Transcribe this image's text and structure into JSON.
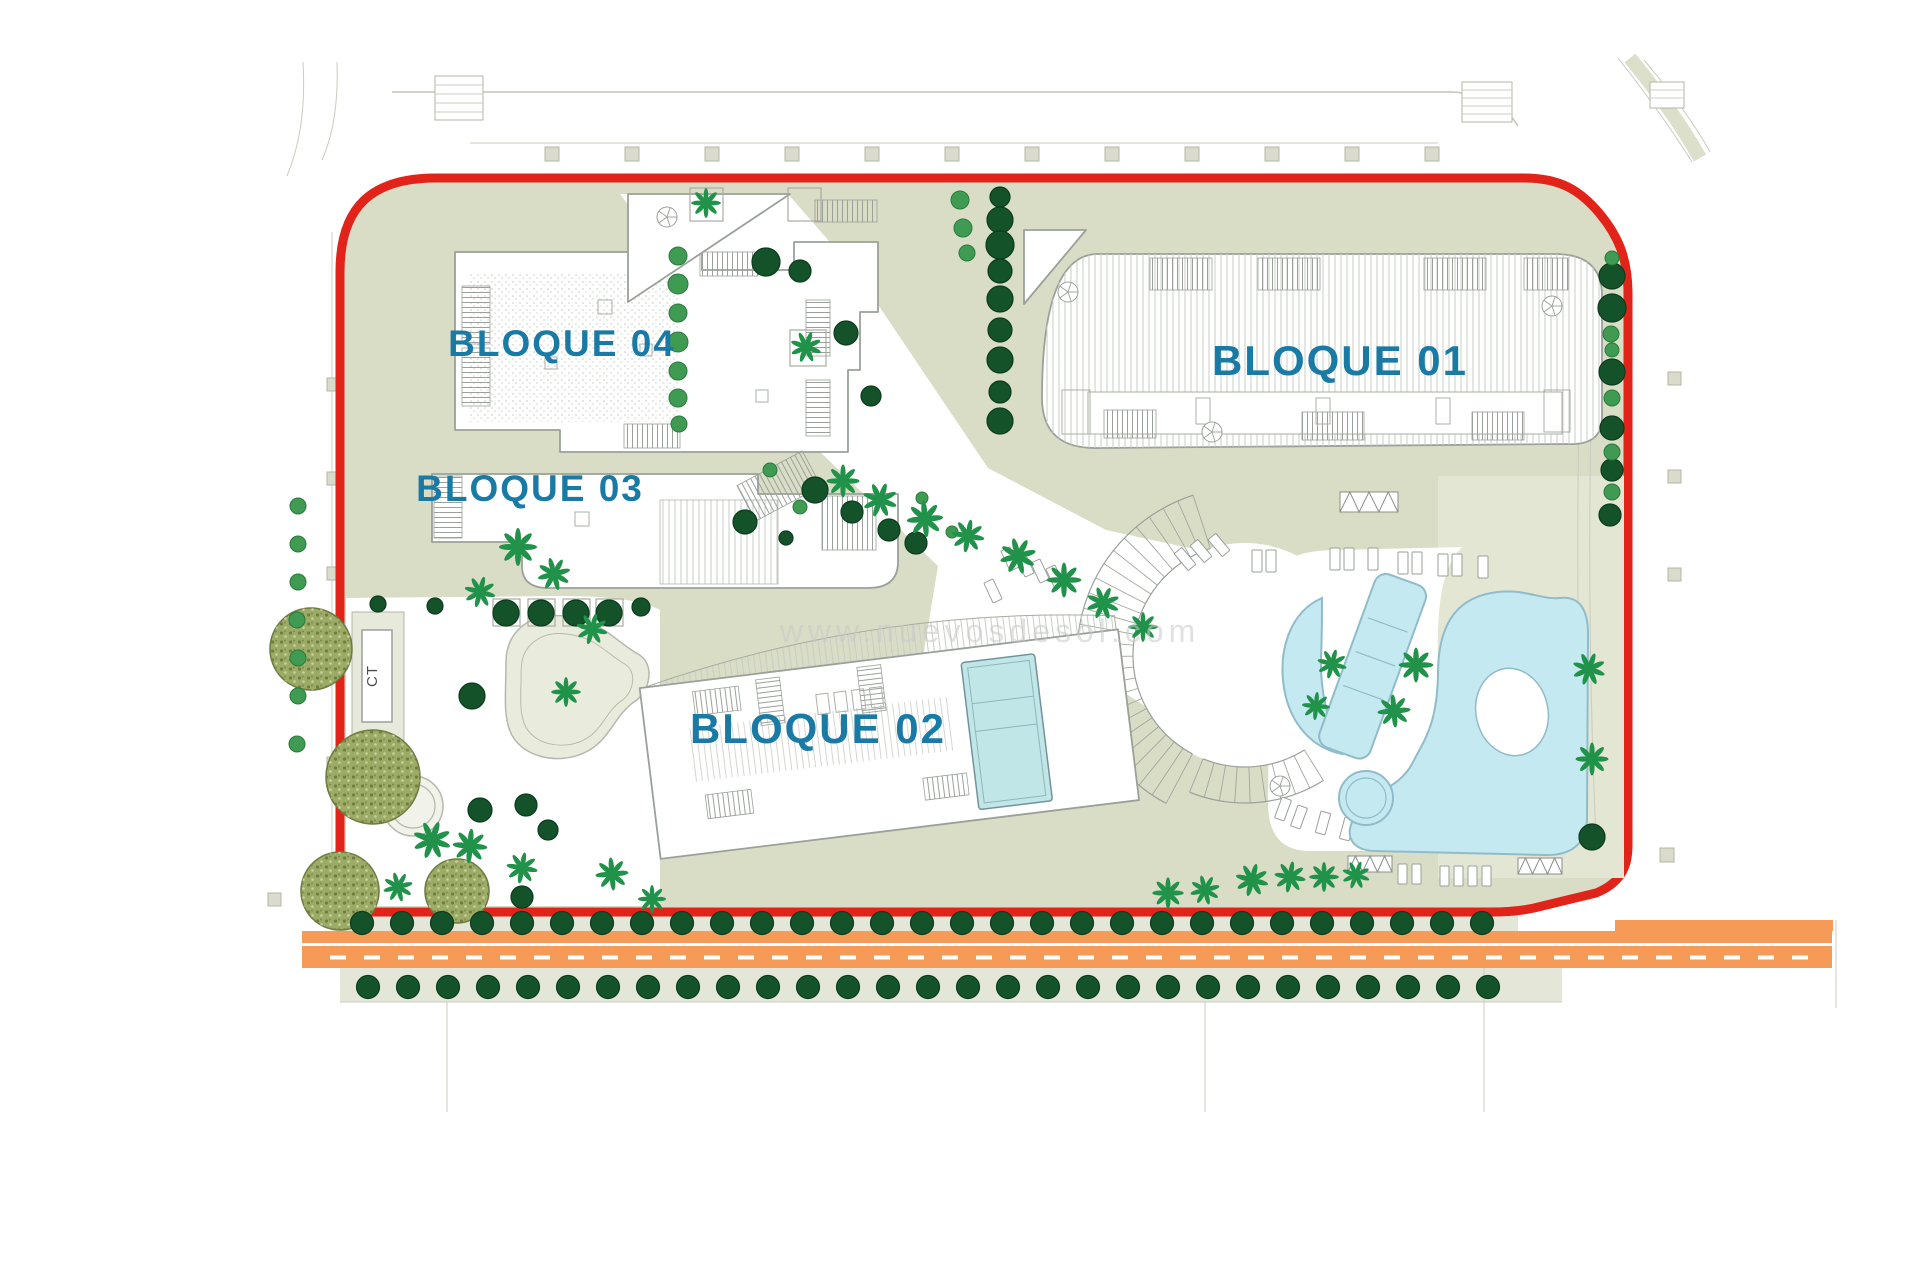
{
  "labels": {
    "blocks": [
      {
        "id": "bloque-01",
        "text": "BLOQUE 01"
      },
      {
        "id": "bloque-02",
        "text": "BLOQUE 02"
      },
      {
        "id": "bloque-03",
        "text": "BLOQUE 03"
      },
      {
        "id": "bloque-04",
        "text": "BLOQUE 04"
      }
    ],
    "transformer": "CT",
    "watermark": "www.nuevosdesol.com"
  },
  "colors": {
    "boundary_red": "#e2231a",
    "sage": "#d9ddc6",
    "sage_light": "#e3e6d3",
    "sage_strip": "#e4e6d7",
    "road_orange": "#f59a57",
    "pool_blue": "#c4e9f1",
    "pool_stroke": "#90bcca",
    "label_blue": "#1a7aa6",
    "watermark_gray": "#c9c9c9",
    "tree_dark": "#14522a",
    "tree_dark_stroke": "#0d3b1e",
    "tree_medium": "#3f9b52",
    "palm_green": "#21924a",
    "olive_fill": "#9cab66",
    "olive_stroke": "#6c7b40"
  },
  "map": {
    "trees_dark": [
      [
        1000,
        197,
        10
      ],
      [
        1000,
        220,
        13
      ],
      [
        1000,
        245,
        14
      ],
      [
        1000,
        271,
        12
      ],
      [
        1000,
        299,
        13
      ],
      [
        1000,
        330,
        12
      ],
      [
        1000,
        360,
        13
      ],
      [
        1000,
        392,
        11
      ],
      [
        1000,
        421,
        13
      ],
      [
        800,
        271,
        11
      ],
      [
        846,
        333,
        12
      ],
      [
        871,
        396,
        10
      ],
      [
        766,
        262,
        14
      ],
      [
        815,
        490,
        13
      ],
      [
        852,
        512,
        11
      ],
      [
        889,
        530,
        11
      ],
      [
        916,
        543,
        11
      ],
      [
        745,
        522,
        12
      ],
      [
        786,
        538,
        7
      ],
      [
        506,
        613,
        13
      ],
      [
        541,
        613,
        13
      ],
      [
        576,
        613,
        13
      ],
      [
        609,
        613,
        13
      ],
      [
        435,
        606,
        8
      ],
      [
        378,
        604,
        8
      ],
      [
        641,
        607,
        9
      ],
      [
        472,
        696,
        13
      ],
      [
        522,
        897,
        11
      ],
      [
        480,
        810,
        12
      ],
      [
        526,
        805,
        11
      ],
      [
        548,
        830,
        10
      ],
      [
        1612,
        276,
        13
      ],
      [
        1612,
        308,
        14
      ],
      [
        1612,
        372,
        13
      ],
      [
        1612,
        428,
        12
      ],
      [
        1612,
        470,
        11
      ],
      [
        1610,
        515,
        11
      ],
      [
        1592,
        837,
        13
      ]
    ],
    "trees_medium": [
      [
        678,
        256,
        9
      ],
      [
        678,
        284,
        10
      ],
      [
        678,
        313,
        9
      ],
      [
        678,
        342,
        10
      ],
      [
        678,
        371,
        9
      ],
      [
        678,
        398,
        9
      ],
      [
        679,
        424,
        8
      ],
      [
        1612,
        258,
        7
      ],
      [
        1611,
        334,
        8
      ],
      [
        1612,
        350,
        7
      ],
      [
        1612,
        398,
        8
      ],
      [
        1612,
        452,
        8
      ],
      [
        1612,
        492,
        8
      ],
      [
        298,
        506,
        8
      ],
      [
        298,
        544,
        8
      ],
      [
        298,
        582,
        8
      ],
      [
        297,
        620,
        8
      ],
      [
        298,
        658,
        8
      ],
      [
        298,
        696,
        8
      ],
      [
        297,
        744,
        8
      ],
      [
        960,
        200,
        9
      ],
      [
        963,
        228,
        9
      ],
      [
        967,
        253,
        8
      ],
      [
        770,
        470,
        7
      ],
      [
        800,
        507,
        7
      ],
      [
        922,
        498,
        6
      ],
      [
        952,
        532,
        6
      ]
    ],
    "palms": [
      [
        843,
        481,
        1.0,
        0
      ],
      [
        880,
        500,
        1.05,
        20
      ],
      [
        925,
        519,
        1.1,
        40
      ],
      [
        968,
        536,
        1.0,
        10
      ],
      [
        1018,
        556,
        1.1,
        30
      ],
      [
        1064,
        580,
        1.05,
        0
      ],
      [
        1103,
        603,
        1.0,
        25
      ],
      [
        1143,
        627,
        0.9,
        45
      ],
      [
        518,
        547,
        1.15,
        0
      ],
      [
        554,
        574,
        1.0,
        30
      ],
      [
        480,
        592,
        0.95,
        60
      ],
      [
        592,
        629,
        0.95,
        15
      ],
      [
        566,
        692,
        0.9,
        0
      ],
      [
        432,
        840,
        1.15,
        20
      ],
      [
        470,
        846,
        1.05,
        50
      ],
      [
        522,
        868,
        0.95,
        10
      ],
      [
        612,
        874,
        1.0,
        40
      ],
      [
        652,
        899,
        0.85,
        0
      ],
      [
        398,
        887,
        0.9,
        30
      ],
      [
        706,
        203,
        0.9,
        0
      ],
      [
        806,
        347,
        0.95,
        20
      ],
      [
        1168,
        893,
        0.95,
        0
      ],
      [
        1205,
        890,
        0.9,
        30
      ],
      [
        1252,
        880,
        1.0,
        60
      ],
      [
        1290,
        877,
        0.95,
        10
      ],
      [
        1324,
        877,
        0.9,
        45
      ],
      [
        1356,
        875,
        0.85,
        20
      ],
      [
        1416,
        665,
        1.05,
        0
      ],
      [
        1394,
        711,
        1.0,
        40
      ],
      [
        1589,
        669,
        1.0,
        20
      ],
      [
        1592,
        759,
        1.0,
        0
      ],
      [
        1332,
        664,
        0.9,
        15
      ],
      [
        1316,
        706,
        0.85,
        50
      ]
    ],
    "olives": [
      [
        311,
        649,
        41
      ],
      [
        373,
        777,
        47
      ],
      [
        340,
        891,
        39
      ],
      [
        457,
        891,
        32
      ]
    ],
    "tree_rows": [
      {
        "y": 923,
        "x0": 362,
        "x1": 1482,
        "step": 40,
        "r": 11.5
      },
      {
        "y": 987,
        "x0": 368,
        "x1": 1488,
        "step": 40,
        "r": 11.5
      }
    ],
    "street_squares": {
      "x0": 545,
      "step": 80,
      "count": 12,
      "y": 147,
      "size": 14
    },
    "squares_extra": [
      [
        327,
        378,
        13
      ],
      [
        327,
        472,
        13
      ],
      [
        327,
        567,
        13
      ],
      [
        327,
        662,
        13
      ],
      [
        327,
        757,
        13
      ],
      [
        1668,
        372,
        13
      ],
      [
        1668,
        470,
        13
      ],
      [
        1668,
        568,
        13
      ],
      [
        268,
        893,
        13
      ],
      [
        1660,
        848,
        14
      ]
    ],
    "planters": [
      [
        493,
        599,
        27
      ],
      [
        528,
        599,
        27
      ],
      [
        563,
        599,
        27
      ],
      [
        596,
        599,
        27
      ],
      [
        690,
        188,
        33
      ],
      [
        788,
        188,
        33
      ],
      [
        790,
        330,
        36
      ]
    ],
    "loungers": [
      [
        1252,
        550,
        10,
        22,
        0
      ],
      [
        1266,
        550,
        10,
        22,
        0
      ],
      [
        1330,
        548,
        10,
        22,
        0
      ],
      [
        1344,
        548,
        10,
        22,
        0
      ],
      [
        1368,
        548,
        10,
        22,
        0
      ],
      [
        1398,
        552,
        10,
        22,
        0
      ],
      [
        1412,
        552,
        10,
        22,
        0
      ],
      [
        1438,
        554,
        10,
        22,
        0
      ],
      [
        1452,
        554,
        10,
        22,
        0
      ],
      [
        1478,
        556,
        10,
        22,
        0
      ],
      [
        1005,
        548,
        10,
        22,
        -25
      ],
      [
        1020,
        554,
        10,
        22,
        -25
      ],
      [
        1035,
        560,
        10,
        22,
        -25
      ],
      [
        1050,
        566,
        10,
        22,
        -25
      ],
      [
        988,
        580,
        10,
        22,
        -25
      ],
      [
        1278,
        798,
        10,
        22,
        20
      ],
      [
        1294,
        806,
        10,
        22,
        20
      ],
      [
        1318,
        812,
        10,
        22,
        15
      ],
      [
        1342,
        818,
        10,
        22,
        15
      ],
      [
        1366,
        822,
        10,
        22,
        10
      ],
      [
        1398,
        864,
        9,
        20,
        0
      ],
      [
        1412,
        864,
        9,
        20,
        0
      ],
      [
        1440,
        866,
        9,
        20,
        0
      ],
      [
        1454,
        866,
        9,
        20,
        0
      ],
      [
        1468,
        866,
        9,
        20,
        0
      ],
      [
        1482,
        866,
        9,
        20,
        0
      ],
      [
        1180,
        548,
        10,
        22,
        -40
      ],
      [
        1196,
        540,
        10,
        22,
        -40
      ],
      [
        1214,
        534,
        10,
        22,
        -40
      ]
    ],
    "fans": [
      {
        "cx": 1245,
        "cy": 655,
        "r1": 112,
        "r2": 168,
        "a1": 118,
        "a2": 252,
        "n": 24
      },
      {
        "cx": 1245,
        "cy": 655,
        "r1": 112,
        "r2": 148,
        "a1": 58,
        "a2": 112,
        "n": 9
      }
    ],
    "trellis": [
      [
        1340,
        492,
        58,
        20
      ],
      [
        1348,
        856,
        44,
        16
      ],
      [
        1518,
        858,
        44,
        16
      ]
    ],
    "b02_rects": [
      [
        822,
        686,
        12,
        20
      ],
      [
        840,
        686,
        12,
        20
      ],
      [
        858,
        686,
        12,
        20
      ],
      [
        876,
        686,
        12,
        20
      ]
    ]
  }
}
